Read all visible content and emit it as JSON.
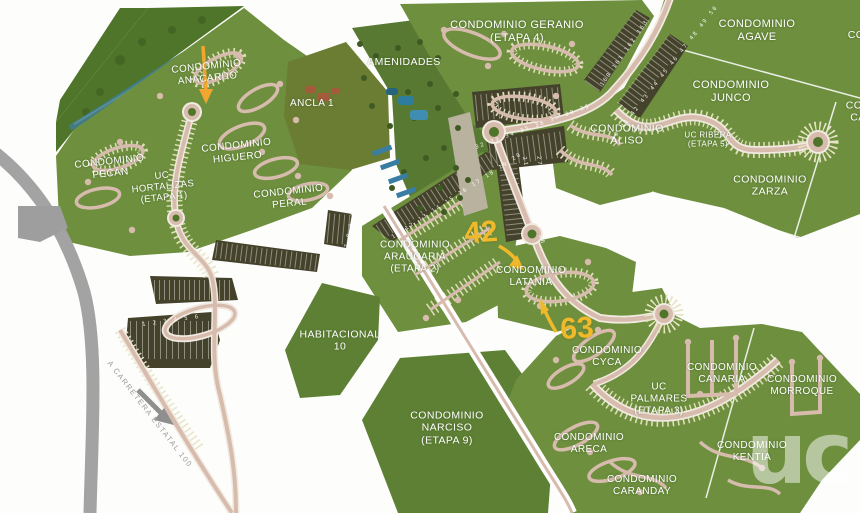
{
  "map": {
    "areas": [
      {
        "id": "anacardo",
        "text": "CONDOMINIO ANACARDO"
      },
      {
        "id": "pecan",
        "text": "CONDOMINIO PECÁN"
      },
      {
        "id": "higuero",
        "text": "CONDOMINIO HIGUERO"
      },
      {
        "id": "hortalizas",
        "text": "UC HORTALIZAS (ETAPA 1)"
      },
      {
        "id": "peral",
        "text": "CONDOMINIO PERAL"
      },
      {
        "id": "ancla",
        "text": "ANCLA 1"
      },
      {
        "id": "amenidades",
        "text": "AMENIDADES"
      },
      {
        "id": "geranio",
        "text": "CONDOMINIO GERANIO (ETAPA 4)"
      },
      {
        "id": "agave",
        "text": "CONDOMINIO AGAVE"
      },
      {
        "id": "junco",
        "text": "CONDOMINIO JUNCO"
      },
      {
        "id": "aliso",
        "text": "CONDOMINIO ALISO"
      },
      {
        "id": "ribera",
        "text": "UC RIBERA (ETAPA 5)"
      },
      {
        "id": "zarza",
        "text": "CONDOMINIO ZARZA"
      },
      {
        "id": "araucaria",
        "text": "CONDOMINIO ARAUCARIA (ETAPA 2)"
      },
      {
        "id": "latania",
        "text": "CONDOMINIO LATANIA"
      },
      {
        "id": "habitacional10",
        "text": "HABITACIONAL 10"
      },
      {
        "id": "narciso",
        "text": "CONDOMINIO NARCISO (ETAPA 9)"
      },
      {
        "id": "cyca",
        "text": "CONDOMINIO CYCA"
      },
      {
        "id": "palmares",
        "text": "UC PALMARES (ETAPA 3)"
      },
      {
        "id": "canaria",
        "text": "CONDOMINIO CANARIA"
      },
      {
        "id": "morroque",
        "text": "CONDOMINIO MORROQUE"
      },
      {
        "id": "areca",
        "text": "CONDOMINIO ARECA"
      },
      {
        "id": "caranday",
        "text": "CONDOMINIO CARANDAY"
      },
      {
        "id": "kentia",
        "text": "CONDOMINIO KENTIA"
      },
      {
        "id": "edge-right-top",
        "text": "CO"
      },
      {
        "id": "edge-right-mid",
        "text": "CON CA"
      }
    ],
    "callouts": {
      "lot_42": "42",
      "lot_63": "63"
    },
    "road_label": "A CARRETERA ESTATAL 100",
    "watermark": "uc",
    "lot_strips": {
      "araucaria_north": "11 12 13 14 15 16 17 18 19 20",
      "araucaria_east": "21 22 23 24 25 26",
      "latania_north": "27 28 29 30 31",
      "aliso_west": "32 33 34 35 36 37 38 39",
      "spine_east": "40 41 42 43 44 45 46 47 48 49 50",
      "spine_west": "160 161 162 163",
      "south": "1 2 3 4 5 6",
      "south_small": "7 8 9 10"
    },
    "colors": {
      "callout_yellow": "#f0b929",
      "map_green": "#6d8f3e",
      "forest_green": "#4e7529",
      "lot_olive": "#45422b",
      "road_tan": "#d7bcae",
      "river_teal": "#417b85",
      "road_gray": "#a3a3a3",
      "label_white": "#ffffff"
    }
  }
}
